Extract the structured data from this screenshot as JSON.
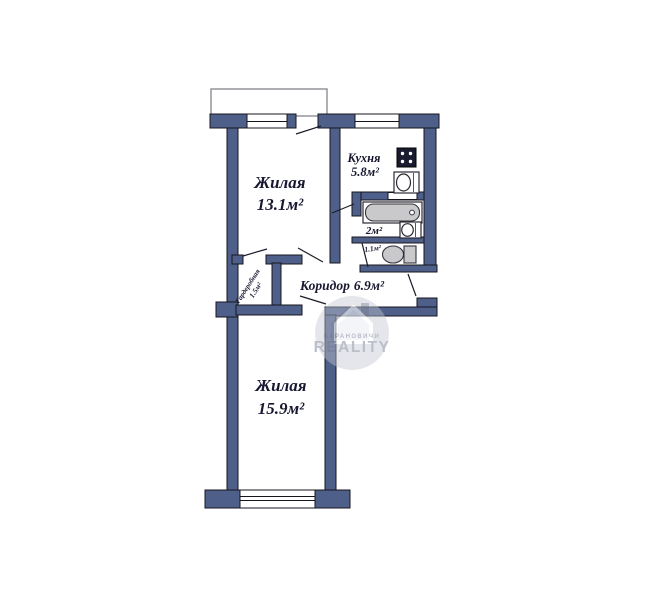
{
  "colors": {
    "wall": "#4e5f8a",
    "label_text": "#181830",
    "fixture_gray": "#c9c9cc",
    "stove_dark": "#1b1b30",
    "watermark_gray": "#9299ab"
  },
  "rooms": {
    "living_top": {
      "name": "Жилая",
      "area": "13.1м²"
    },
    "kitchen": {
      "name": "Кухня",
      "area": "5.8м²"
    },
    "bathroom": {
      "area": "2м²"
    },
    "toilet": {
      "area": "1.1м²"
    },
    "corridor": {
      "name": "Коридор",
      "area": "6.9м²"
    },
    "wardrobe": {
      "name": "Гардеробная",
      "area": "1.5м²"
    },
    "living_bottom": {
      "name": "Жилая",
      "area": "15.9м²"
    }
  },
  "icons": {
    "stove": "stove-icon",
    "kitchen_sink": "sink-icon",
    "bathtub": "bathtub-icon",
    "bathroom_sink": "sink-icon",
    "toilet": "toilet-icon",
    "logo_house": "house-logo-icon"
  },
  "watermark": {
    "brand_top": "БАРАНОВИЧИ",
    "brand_main": "REALITY"
  }
}
